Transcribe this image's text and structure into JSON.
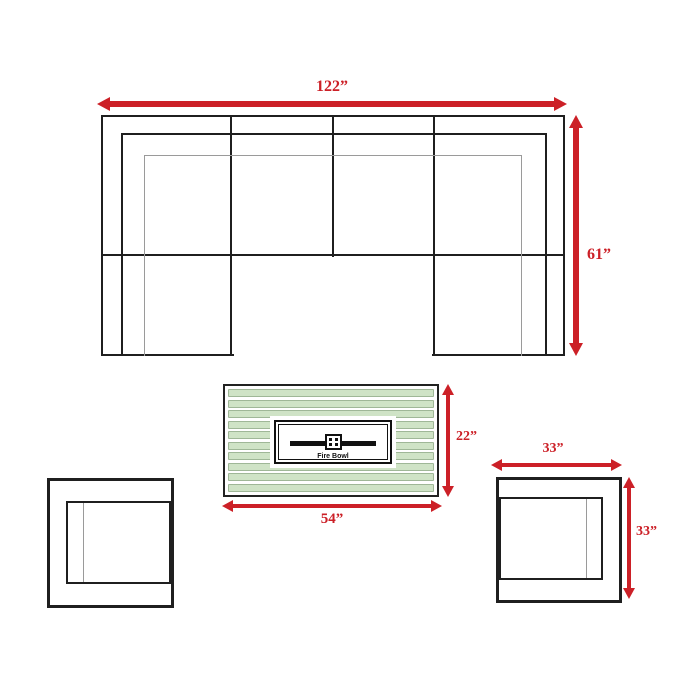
{
  "diagram": {
    "sectional": {
      "width_label": "122”",
      "depth_label": "61”"
    },
    "fire_table": {
      "width_label": "54”",
      "height_label": "22”",
      "center_label": "Fire Bowl"
    },
    "club_chair_right": {
      "width_label": "33”",
      "height_label": "33”"
    }
  },
  "colors": {
    "arrow_red": "#cc2027",
    "outline_black": "#1f1f1f",
    "thin_line_gray": "#9a9a9a",
    "slat_green": "#cfe3c6",
    "slat_border_green": "#9fb797",
    "background": "#ffffff"
  }
}
